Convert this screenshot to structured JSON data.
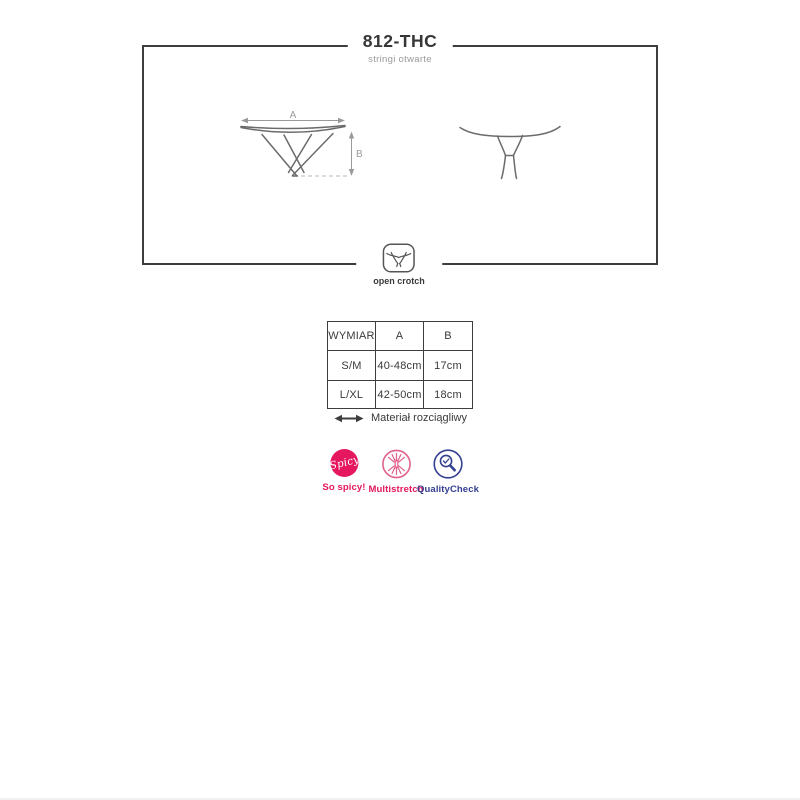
{
  "header": {
    "title": "812-THC",
    "subtitle": "stringi otwarte"
  },
  "diagram": {
    "front": {
      "dim_a": "A",
      "dim_b": "B"
    },
    "open_crotch_label": "open crotch"
  },
  "size_table": {
    "headers": [
      "WYMIAR",
      "A",
      "B"
    ],
    "rows": [
      [
        "S/M",
        "40-48cm",
        "17cm"
      ],
      [
        "L/XL",
        "42-50cm",
        "18cm"
      ]
    ]
  },
  "material_note": {
    "text": "Materiał rozciągliwy",
    "icon": "stretch-arrow-icon"
  },
  "badges": [
    {
      "label": "So spicy!",
      "circle_text": "Spicy",
      "icon": "spicy-badge-icon",
      "color": "#e4175f"
    },
    {
      "label": "Multistretch",
      "icon": "multistretch-icon",
      "color": "#e4175f"
    },
    {
      "label": "QualityCheck",
      "icon": "qualitycheck-icon",
      "color": "#333f8f"
    }
  ],
  "colors": {
    "line_dark": "#3d3d3d",
    "drawing_gray": "#6b6b6b",
    "dimension_gray": "#9a9a9a",
    "brand_pink": "#e4175f",
    "brand_navy": "#333f8f"
  }
}
